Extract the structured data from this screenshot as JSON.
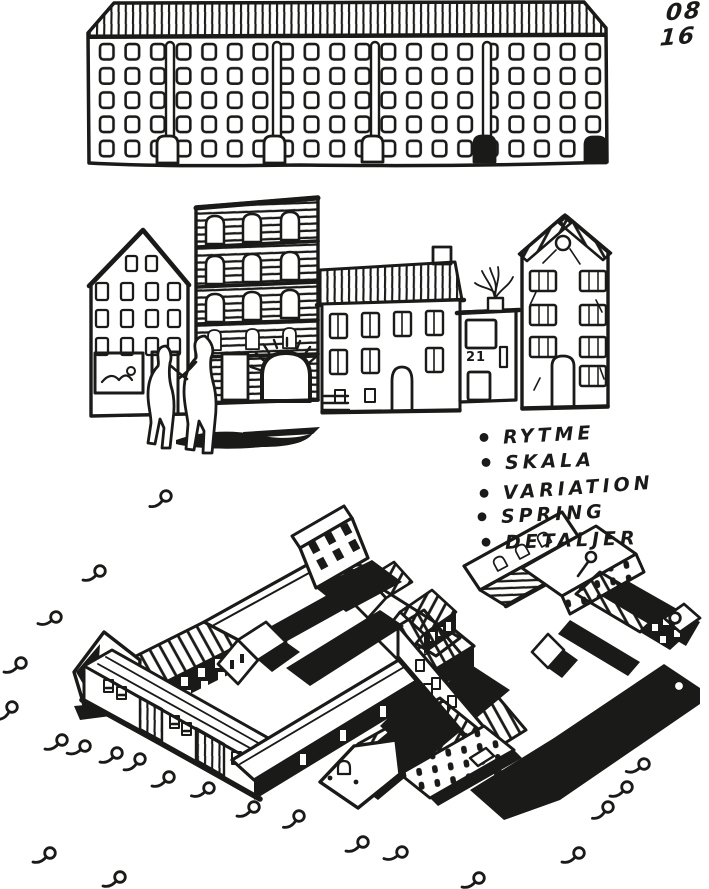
{
  "page": {
    "background": "#ffffff",
    "ink": "#1a1a19"
  },
  "corner_note": {
    "line1": "08",
    "line2": "16"
  },
  "principles_list": {
    "bullet": "•",
    "items": [
      {
        "label": "RYTME"
      },
      {
        "label": "SKALA"
      },
      {
        "label": "VARIATION"
      },
      {
        "label": "SPRING"
      },
      {
        "label": "DETALJER"
      }
    ]
  },
  "street_scene": {
    "house_number_label": "21"
  }
}
